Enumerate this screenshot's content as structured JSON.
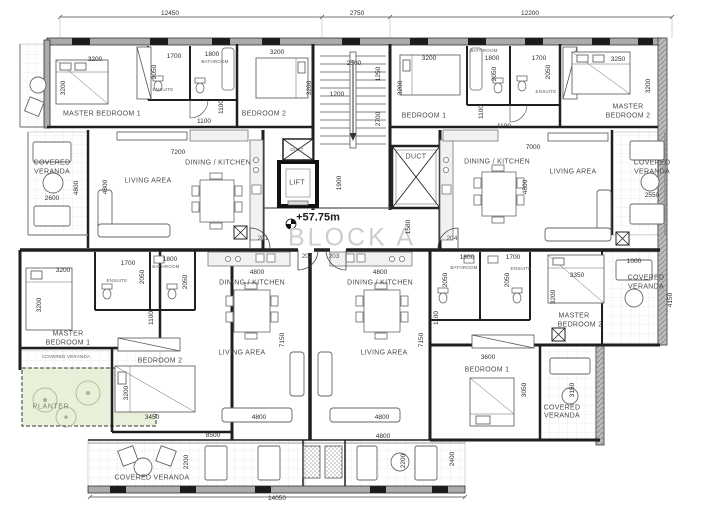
{
  "drawing": {
    "block_title": "BLOCK A",
    "level_annotation": "+57.75m",
    "unit_numbers": [
      "201",
      "202",
      "203",
      "204"
    ],
    "overall_dimensions": {
      "top": [
        "12450",
        "2750",
        "12200"
      ],
      "bottom": [
        "14050"
      ]
    }
  },
  "colors": {
    "wall_dark": "#1f1f1f",
    "wall_fill_gray": "#ababab",
    "planter_fill": "#e9f0da",
    "veranda_grid": "#dddddd",
    "block_title_text": "#cdcdcd"
  },
  "labels": [
    {
      "t": "12450",
      "x": 170,
      "y": 14,
      "k": "d"
    },
    {
      "t": "2750",
      "x": 357,
      "y": 14,
      "k": "d"
    },
    {
      "t": "12200",
      "x": 530,
      "y": 14,
      "k": "d"
    },
    {
      "t": "3200",
      "x": 95,
      "y": 60,
      "k": "d"
    },
    {
      "t": "3200",
      "x": 64,
      "y": 88,
      "k": "dv"
    },
    {
      "t": "1700",
      "x": 174,
      "y": 57,
      "k": "d"
    },
    {
      "t": "1800",
      "x": 212,
      "y": 55,
      "k": "d"
    },
    {
      "t": "BATHROOM",
      "x": 215,
      "y": 62,
      "k": "t"
    },
    {
      "t": "2050",
      "x": 155,
      "y": 72,
      "k": "dv"
    },
    {
      "t": "ENSUITE",
      "x": 163,
      "y": 90,
      "k": "t"
    },
    {
      "t": "3200",
      "x": 277,
      "y": 53,
      "k": "d"
    },
    {
      "t": "3200",
      "x": 310,
      "y": 88,
      "k": "dv"
    },
    {
      "t": "MASTER BEDROOM 1",
      "x": 102,
      "y": 114,
      "k": "r"
    },
    {
      "t": "BEDROOM 2",
      "x": 264,
      "y": 114,
      "k": "r"
    },
    {
      "t": "1100",
      "x": 222,
      "y": 107,
      "k": "dv"
    },
    {
      "t": "1100",
      "x": 204,
      "y": 122,
      "k": "d"
    },
    {
      "t": "2500",
      "x": 354,
      "y": 64,
      "k": "d"
    },
    {
      "t": "1250",
      "x": 379,
      "y": 74,
      "k": "dv"
    },
    {
      "t": "1200",
      "x": 337,
      "y": 95,
      "k": "d"
    },
    {
      "t": "2700",
      "x": 379,
      "y": 119,
      "k": "dv"
    },
    {
      "t": "3200",
      "x": 429,
      "y": 59,
      "k": "d"
    },
    {
      "t": "3200",
      "x": 401,
      "y": 88,
      "k": "dv"
    },
    {
      "t": "BEDROOM 1",
      "x": 424,
      "y": 116,
      "k": "r"
    },
    {
      "t": "BATHROOM",
      "x": 484,
      "y": 51,
      "k": "t"
    },
    {
      "t": "1800",
      "x": 492,
      "y": 59,
      "k": "d"
    },
    {
      "t": "2050",
      "x": 495,
      "y": 74,
      "k": "dv"
    },
    {
      "t": "1700",
      "x": 539,
      "y": 59,
      "k": "d"
    },
    {
      "t": "2050",
      "x": 549,
      "y": 72,
      "k": "dv"
    },
    {
      "t": "ENSUITE",
      "x": 546,
      "y": 92,
      "k": "t"
    },
    {
      "t": "1100",
      "x": 482,
      "y": 112,
      "k": "dv"
    },
    {
      "t": "1100",
      "x": 504,
      "y": 127,
      "k": "d"
    },
    {
      "t": "3250",
      "x": 618,
      "y": 60,
      "k": "d"
    },
    {
      "t": "3200",
      "x": 649,
      "y": 86,
      "k": "dv"
    },
    {
      "t": "MASTER",
      "x": 628,
      "y": 107,
      "k": "r"
    },
    {
      "t": "BEDROOM 2",
      "x": 628,
      "y": 116,
      "k": "r"
    },
    {
      "t": "COVERED",
      "x": 52,
      "y": 163,
      "k": "r"
    },
    {
      "t": "VERANDA",
      "x": 52,
      "y": 172,
      "k": "r"
    },
    {
      "t": "2600",
      "x": 52,
      "y": 199,
      "k": "d"
    },
    {
      "t": "7200",
      "x": 178,
      "y": 153,
      "k": "d"
    },
    {
      "t": "DINING / KITCHEN",
      "x": 218,
      "y": 163,
      "k": "r"
    },
    {
      "t": "LIVING AREA",
      "x": 148,
      "y": 181,
      "k": "r"
    },
    {
      "t": "4800",
      "x": 77,
      "y": 188,
      "k": "dv"
    },
    {
      "t": "4800",
      "x": 106,
      "y": 187,
      "k": "dv"
    },
    {
      "t": "DUCT",
      "x": 297,
      "y": 150,
      "k": "t"
    },
    {
      "t": "LIFT",
      "x": 297,
      "y": 183,
      "k": "r"
    },
    {
      "t": "1900",
      "x": 340,
      "y": 183,
      "k": "dv"
    },
    {
      "t": "DUCT",
      "x": 416,
      "y": 157,
      "k": "r"
    },
    {
      "t": "+57.75m",
      "x": 318,
      "y": 218,
      "k": "l"
    },
    {
      "t": "BLOCK A",
      "x": 352,
      "y": 238,
      "k": "b"
    },
    {
      "t": "201",
      "x": 263,
      "y": 239,
      "k": "u"
    },
    {
      "t": "204",
      "x": 452,
      "y": 239,
      "k": "u"
    },
    {
      "t": "202",
      "x": 307,
      "y": 257,
      "k": "u"
    },
    {
      "t": "203",
      "x": 334,
      "y": 257,
      "k": "u"
    },
    {
      "t": "1580",
      "x": 409,
      "y": 227,
      "k": "dv"
    },
    {
      "t": "7000",
      "x": 533,
      "y": 148,
      "k": "d"
    },
    {
      "t": "DINING / KITCHEN",
      "x": 497,
      "y": 162,
      "k": "r"
    },
    {
      "t": "LIVING AREA",
      "x": 573,
      "y": 172,
      "k": "r"
    },
    {
      "t": "4800",
      "x": 526,
      "y": 187,
      "k": "dv"
    },
    {
      "t": "COVERED",
      "x": 652,
      "y": 163,
      "k": "r"
    },
    {
      "t": "VERANDA",
      "x": 652,
      "y": 172,
      "k": "r"
    },
    {
      "t": "2550",
      "x": 652,
      "y": 196,
      "k": "d"
    },
    {
      "t": "3200",
      "x": 63,
      "y": 271,
      "k": "d"
    },
    {
      "t": "1700",
      "x": 128,
      "y": 264,
      "k": "d"
    },
    {
      "t": "1800",
      "x": 170,
      "y": 260,
      "k": "d"
    },
    {
      "t": "BATHROOM",
      "x": 166,
      "y": 267,
      "k": "t"
    },
    {
      "t": "ENSUITE",
      "x": 117,
      "y": 281,
      "k": "t"
    },
    {
      "t": "2050",
      "x": 143,
      "y": 277,
      "k": "dv"
    },
    {
      "t": "2050",
      "x": 186,
      "y": 282,
      "k": "dv"
    },
    {
      "t": "3200",
      "x": 40,
      "y": 305,
      "k": "dv"
    },
    {
      "t": "MASTER",
      "x": 68,
      "y": 334,
      "k": "r"
    },
    {
      "t": "BEDROOM 1",
      "x": 68,
      "y": 343,
      "k": "r"
    },
    {
      "t": "COVERED VERANDA",
      "x": 66,
      "y": 357,
      "k": "t"
    },
    {
      "t": "1100",
      "x": 152,
      "y": 318,
      "k": "dv"
    },
    {
      "t": "BEDROOM 2",
      "x": 160,
      "y": 361,
      "k": "r"
    },
    {
      "t": "3200",
      "x": 127,
      "y": 393,
      "k": "dv"
    },
    {
      "t": "3450",
      "x": 152,
      "y": 418,
      "k": "d"
    },
    {
      "t": "PLANTER",
      "x": 51,
      "y": 407,
      "k": "p"
    },
    {
      "t": "8500",
      "x": 213,
      "y": 436,
      "k": "d"
    },
    {
      "t": "2200",
      "x": 187,
      "y": 462,
      "k": "dv"
    },
    {
      "t": "COVERED VERANDA",
      "x": 152,
      "y": 478,
      "k": "r"
    },
    {
      "t": "14050",
      "x": 277,
      "y": 499,
      "k": "d"
    },
    {
      "t": "4800",
      "x": 257,
      "y": 273,
      "k": "d"
    },
    {
      "t": "DINING / KITCHEN",
      "x": 252,
      "y": 283,
      "k": "r"
    },
    {
      "t": "7150",
      "x": 283,
      "y": 340,
      "k": "dv"
    },
    {
      "t": "LIVING AREA",
      "x": 242,
      "y": 353,
      "k": "r"
    },
    {
      "t": "4800",
      "x": 259,
      "y": 418,
      "k": "d"
    },
    {
      "t": "4800",
      "x": 380,
      "y": 273,
      "k": "d"
    },
    {
      "t": "DINING / KITCHEN",
      "x": 380,
      "y": 283,
      "k": "r"
    },
    {
      "t": "7150",
      "x": 422,
      "y": 340,
      "k": "dv"
    },
    {
      "t": "LIVING AREA",
      "x": 384,
      "y": 353,
      "k": "r"
    },
    {
      "t": "4800",
      "x": 382,
      "y": 418,
      "k": "d"
    },
    {
      "t": "4800",
      "x": 383,
      "y": 437,
      "k": "d"
    },
    {
      "t": "2200",
      "x": 404,
      "y": 461,
      "k": "dv"
    },
    {
      "t": "2400",
      "x": 453,
      "y": 459,
      "k": "dv"
    },
    {
      "t": "1800",
      "x": 467,
      "y": 258,
      "k": "d"
    },
    {
      "t": "BATHROOM",
      "x": 464,
      "y": 268,
      "k": "t"
    },
    {
      "t": "1700",
      "x": 513,
      "y": 258,
      "k": "d"
    },
    {
      "t": "ENSUITE",
      "x": 521,
      "y": 269,
      "k": "t"
    },
    {
      "t": "2050",
      "x": 446,
      "y": 280,
      "k": "dv"
    },
    {
      "t": "2050",
      "x": 508,
      "y": 280,
      "k": "dv"
    },
    {
      "t": "1100",
      "x": 437,
      "y": 318,
      "k": "dv"
    },
    {
      "t": "3350",
      "x": 577,
      "y": 276,
      "k": "d"
    },
    {
      "t": "3200",
      "x": 554,
      "y": 297,
      "k": "dv"
    },
    {
      "t": "MASTER",
      "x": 574,
      "y": 316,
      "k": "r"
    },
    {
      "t": "BEDROOM 2",
      "x": 580,
      "y": 325,
      "k": "r"
    },
    {
      "t": "1000",
      "x": 634,
      "y": 262,
      "k": "d"
    },
    {
      "t": "COVERED",
      "x": 646,
      "y": 278,
      "k": "r"
    },
    {
      "t": "VERANDA",
      "x": 646,
      "y": 287,
      "k": "r"
    },
    {
      "t": "4150",
      "x": 671,
      "y": 300,
      "k": "dv"
    },
    {
      "t": "3600",
      "x": 488,
      "y": 358,
      "k": "d"
    },
    {
      "t": "BEDROOM 1",
      "x": 487,
      "y": 370,
      "k": "r"
    },
    {
      "t": "3050",
      "x": 525,
      "y": 390,
      "k": "dv"
    },
    {
      "t": "3150",
      "x": 573,
      "y": 390,
      "k": "dv"
    },
    {
      "t": "COVERED",
      "x": 562,
      "y": 408,
      "k": "r"
    },
    {
      "t": "VERANDA",
      "x": 562,
      "y": 416,
      "k": "r"
    }
  ]
}
